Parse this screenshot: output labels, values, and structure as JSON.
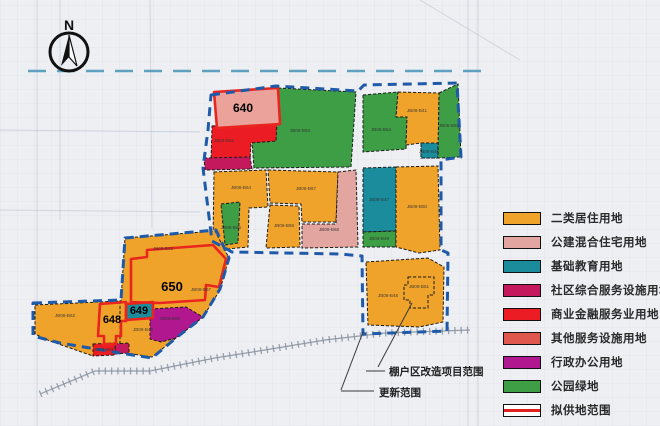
{
  "compass": {
    "label": "N"
  },
  "legend": {
    "items": [
      {
        "label": "二类居住用地",
        "color": "#F0A32A",
        "type": "fill"
      },
      {
        "label": "公建混合住宅用地",
        "color": "#E2A5A0",
        "type": "fill"
      },
      {
        "label": "基础教育用地",
        "color": "#1A8C9B",
        "type": "fill"
      },
      {
        "label": "社区综合服务设施用地",
        "color": "#C4195C",
        "type": "fill"
      },
      {
        "label": "商业金融服务业用地",
        "color": "#EC1C24",
        "type": "fill"
      },
      {
        "label": "其他服务设施用地",
        "color": "#E0574E",
        "type": "fill"
      },
      {
        "label": "行政办公用地",
        "color": "#B1178F",
        "type": "fill"
      },
      {
        "label": "公园绿地",
        "color": "#3D9E46",
        "type": "fill"
      },
      {
        "label": "拟供地范围",
        "color": "#e02020",
        "type": "supply"
      }
    ]
  },
  "map": {
    "boundary_color": "#1E5AA8",
    "boundaries": [
      {
        "name": "north-district-boundary",
        "points": "211,95 276,86 358,91 364,85 457,83 461,157 441,160 441,250 448,253 447,331 363,334 362,256 340,254 232,252 212,241 203,168 208,130"
      },
      {
        "name": "southwest-district-boundary",
        "points": "33,303 121,300 125,238 216,230 229,258 220,289 203,317 176,338 152,358 120,353 60,343 33,336"
      }
    ],
    "parcels": [
      {
        "name": "parcel-park-north-large",
        "points": "278,88 356,92 351,167 254,168 252,142 276,140",
        "fill": "#3D9E46",
        "stroke": "dash"
      },
      {
        "name": "parcel-commercial-640-south",
        "points": "212,126 277,122 276,141 251,143 250,161 211,162",
        "fill": "#EC1C24",
        "stroke": "dash"
      },
      {
        "name": "parcel-community-sliver",
        "points": "204,158 250,157 252,169 205,170",
        "fill": "#C4195C",
        "stroke": "dash"
      },
      {
        "name": "parcel-640",
        "points": "214,92 278,88 280,124 217,128",
        "fill": "#EBA29B",
        "stroke": "red"
      },
      {
        "name": "parcel-park-ne-left",
        "points": "363,95 398,92 396,117 407,117 406,149 363,152",
        "fill": "#3D9E46",
        "stroke": "dash"
      },
      {
        "name": "parcel-residential-ne",
        "points": "398,92 439,93 438,158 421,158 421,143 406,145 407,117 396,117",
        "fill": "#F0A32A",
        "stroke": "dash"
      },
      {
        "name": "parcel-education-ne-small",
        "points": "421,143 438,143 438,158 421,158",
        "fill": "#1A8C9B",
        "stroke": "dash"
      },
      {
        "name": "parcel-park-ne-right",
        "points": "439,93 458,84 461,157 438,158",
        "fill": "#3D9E46",
        "stroke": "dash"
      },
      {
        "name": "parcel-residential-mid-left",
        "points": "214,172 266,170 268,207 249,208 248,247 227,249 213,240",
        "fill": "#F0A32A",
        "stroke": "dash"
      },
      {
        "name": "parcel-park-strip",
        "points": "221,204 240,202 238,243 225,245",
        "fill": "#3D9E46",
        "stroke": "dash"
      },
      {
        "name": "parcel-residential-mid-center",
        "points": "268,170 338,172 336,222 302,222 301,204 270,203",
        "fill": "#F0A32A",
        "stroke": "dash"
      },
      {
        "name": "parcel-residential-mid-lower",
        "points": "270,205 299,206 300,247 266,248",
        "fill": "#F0A32A",
        "stroke": "dash"
      },
      {
        "name": "parcel-mixed-mid-right",
        "points": "338,172 356,170 358,247 302,248 302,224 336,224",
        "fill": "#E2A5A0",
        "stroke": "dash"
      },
      {
        "name": "parcel-education-east",
        "points": "363,168 396,167 396,231 363,232",
        "fill": "#1A8C9B",
        "stroke": "dash"
      },
      {
        "name": "parcel-park-east-small",
        "points": "363,232 396,231 396,247 363,247",
        "fill": "#3D9E46",
        "stroke": "dash"
      },
      {
        "name": "parcel-residential-east",
        "points": "396,167 438,166 440,250 419,253 396,247",
        "fill": "#F0A32A",
        "stroke": "dash"
      },
      {
        "name": "parcel-residential-southeast",
        "points": "366,262 428,258 444,267 443,322 419,327 368,325",
        "fill": "#F0A32A",
        "stroke": "dash"
      },
      {
        "name": "parcel-southeast-subarea",
        "points": "408,277 434,277 434,295 428,295 428,308 410,308 410,300 404,300 404,285 408,285",
        "fill": "none",
        "stroke": "dash"
      },
      {
        "name": "parcel-residential-west-base",
        "points": "99,303 121,301 125,238 215,231 229,258 220,290 203,317 176,338 152,357 120,352 97,347",
        "fill": "#F0A32A",
        "stroke": "dash"
      },
      {
        "name": "parcel-residential-west-lower",
        "points": "35,305 120,301 120,343 95,345 93,356 50,341 35,334",
        "fill": "#F0A32A",
        "stroke": "dash"
      },
      {
        "name": "parcel-admin-west",
        "points": "150,309 186,307 203,317 176,338 161,342 150,339",
        "fill": "#B1178F",
        "stroke": "dash"
      },
      {
        "name": "parcel-community-west-small",
        "points": "115,344 129,343 129,353 115,354",
        "fill": "#C4195C",
        "stroke": "dash"
      },
      {
        "name": "parcel-commercial-west-small",
        "points": "93,344 115,343 115,355 93,356",
        "fill": "#EC1C24",
        "stroke": "dash"
      },
      {
        "name": "parcel-649",
        "points": "126,304 153,302 153,318 126,320",
        "fill": "#1A8C9B",
        "stroke": "red"
      },
      {
        "name": "supply-outline-650",
        "points": "131,259 147,257 147,250 213,245 226,259 219,287 206,285 205,300 160,303 131,302",
        "fill": "none",
        "stroke": "red"
      },
      {
        "name": "supply-outline-648",
        "points": "100,304 126,302 126,321 121,321 121,336 116,336 116,344 104,344 104,336 98,336",
        "fill": "none",
        "stroke": "red"
      }
    ],
    "block_numbers": [
      {
        "text": "640",
        "x": 243,
        "y": 112,
        "size": 12
      },
      {
        "text": "650",
        "x": 172,
        "y": 291,
        "size": 13
      },
      {
        "text": "649",
        "x": 139,
        "y": 314,
        "size": 11
      },
      {
        "text": "648",
        "x": 112,
        "y": 323,
        "size": 11
      }
    ],
    "parcel_codes": [
      {
        "text": "JB08-B52",
        "x": 224,
        "y": 142
      },
      {
        "text": "JB08-B53",
        "x": 300,
        "y": 132
      },
      {
        "text": "JB08-B54",
        "x": 381,
        "y": 131
      },
      {
        "text": "JB08-B41",
        "x": 417,
        "y": 112
      },
      {
        "text": "JB08-B46",
        "x": 429,
        "y": 153
      },
      {
        "text": "JB08-B55",
        "x": 449,
        "y": 127
      },
      {
        "text": "JB08-B64",
        "x": 241,
        "y": 189
      },
      {
        "text": "JB08-B66",
        "x": 231,
        "y": 229
      },
      {
        "text": "JB08-B67",
        "x": 306,
        "y": 190
      },
      {
        "text": "JB08-B65",
        "x": 284,
        "y": 227
      },
      {
        "text": "JB08-B68",
        "x": 329,
        "y": 231
      },
      {
        "text": "JB08-B47",
        "x": 379,
        "y": 201
      },
      {
        "text": "JB08-B49",
        "x": 379,
        "y": 240
      },
      {
        "text": "JB08-B50",
        "x": 417,
        "y": 208
      },
      {
        "text": "JB08-B48",
        "x": 388,
        "y": 297
      },
      {
        "text": "JB08-B51",
        "x": 419,
        "y": 288
      },
      {
        "text": "JB08-B62",
        "x": 65,
        "y": 317
      },
      {
        "text": "JB08-B63",
        "x": 163,
        "y": 250
      },
      {
        "text": "JB08-B57",
        "x": 201,
        "y": 291
      },
      {
        "text": "JB08-B45",
        "x": 143,
        "y": 331
      },
      {
        "text": "JB08-B60",
        "x": 170,
        "y": 320
      },
      {
        "text": "JB08-B61",
        "x": 104,
        "y": 351
      }
    ],
    "annotations": [
      {
        "name": "annotation-shantytown",
        "text": "棚户区改造项目范围",
        "x": 389,
        "y": 375
      },
      {
        "name": "annotation-renewal",
        "text": "更新范围",
        "x": 379,
        "y": 396
      }
    ],
    "leaders": [
      {
        "points": "412,303 378,367"
      },
      {
        "points": "366,371 385,371"
      },
      {
        "points": "363,332 341,390"
      },
      {
        "points": "341,391 374,391"
      }
    ],
    "infra": {
      "top_dashed_road": {
        "points": "28,71 492,71",
        "color": "#4E97B8"
      },
      "railway": {
        "points": "40,394 95,371 150,371 215,358 265,350 325,340 385,333 470,330",
        "color": "#8a93a0"
      },
      "faint_roads": [
        {
          "points": "37,0 37,426"
        },
        {
          "points": "468,0 468,426"
        },
        {
          "points": "478,0 478,426"
        },
        {
          "points": "0,210 200,212"
        },
        {
          "points": "150,0 152,228"
        },
        {
          "points": "420,0 520,60"
        },
        {
          "points": "60,0 60,220"
        },
        {
          "points": "0,130 200,132"
        }
      ]
    }
  }
}
